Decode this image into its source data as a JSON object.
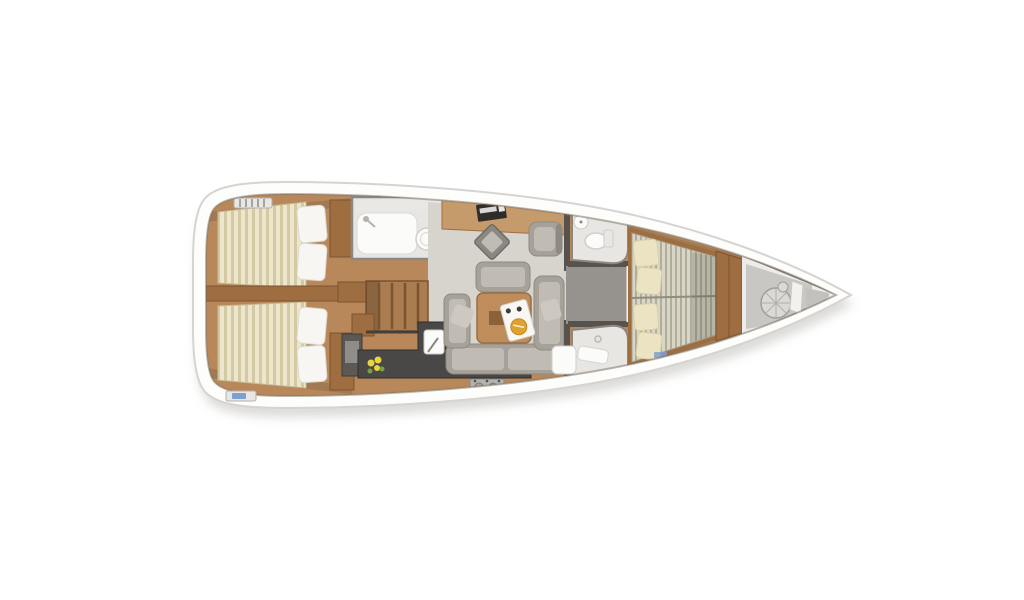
{
  "diagram": {
    "type": "sailing-yacht-interior-floor-plan",
    "orientation": "bow-right",
    "areas": [
      "aft-cabin-port",
      "aft-cabin-starboard",
      "aft-head",
      "companionway-stairs",
      "galley",
      "salon",
      "nav-station",
      "forward-head",
      "forward-shower",
      "corridor",
      "forward-cabin",
      "anchor-locker"
    ]
  },
  "colors": {
    "background": "#ffffff",
    "shadow": "#b9b7b3",
    "hull": "#fdfdfb",
    "hull_edge": "#d6d4d0",
    "wood_floor": "#b8885a",
    "wood_light": "#c59b6c",
    "wood_trim": "#9e6e41",
    "wood_dark": "#7a5330",
    "stair_wood": "#aa7c4f",
    "mattress": "#ede6cc",
    "mattress_stripe": "#d3c9a3",
    "mattress_fwd": "#d9d6c5",
    "mattress_fwd_stripe": "#b0ad9c",
    "pillow_white": "#f7f6f2",
    "pillow_cream": "#ebe3c1",
    "salon_floor": "#d7d4ce",
    "bath_floor": "#e7e6e3",
    "shelf": "#e9e8e5",
    "fixture": "#fbfbf9",
    "wall_gray": "#8b8782",
    "wall_dark": "#57524c",
    "corridor": "#96938e",
    "counter": "#4a4846",
    "cabinet_dark": "#5c5955",
    "sofa": "#a6a299",
    "sofa_light": "#c0bcb3",
    "sofa_dark": "#8e8a82",
    "throw_pillow": "#cdc9c0",
    "table": "#bf8d5c",
    "table_inset": "#8a6138",
    "tray": "#f8f7f4",
    "plate": "#dfa12f",
    "flower_yellow": "#e8d53f",
    "flower_green": "#7ba043",
    "decor_bg": "#e3ddc8",
    "decor_red": "#c2574a",
    "decor_blue": "#5a79b0",
    "metal": "#b5b3af",
    "bow_floor": "#edecea",
    "bow_gray": "#c9c7c3",
    "bow_wedge": "#c3c1bd",
    "windlass": "#dbd9d5",
    "hatch_blue": "#7f9fd1",
    "vent": "#e8e7e3",
    "shade": "rgba(70,63,55,0.20)",
    "bed_shade": "rgba(85,82,75,0.25)"
  }
}
